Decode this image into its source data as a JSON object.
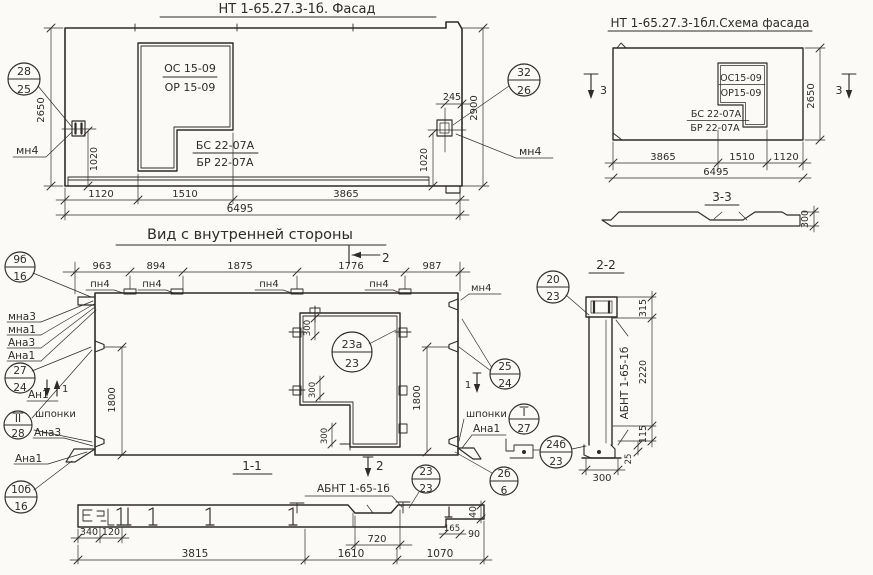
{
  "palette": {
    "paper": "#fbfaf6",
    "ink": "#2e2b28"
  },
  "facade": {
    "title": "НТ 1-65.27.3-1б. Фасад",
    "window_block": {
      "line1": "ОС 15-09",
      "line2": "ОР 15-09"
    },
    "door_block": {
      "line1": "БС 22-07А",
      "line2": "БР 22-07А"
    },
    "plate_left": "мн4",
    "plate_right": "мн4",
    "callout_left": {
      "top": "28",
      "bottom": "25"
    },
    "callout_right": {
      "top": "32",
      "bottom": "26"
    },
    "dim_height_left": "2650",
    "dim_height_right": "2900",
    "dim_plate_left": "1020",
    "dim_plate_right": "1020",
    "dim_offset": "245",
    "dims_bottom": [
      "1120",
      "1510",
      "3865"
    ],
    "dim_total": "6495"
  },
  "scheme": {
    "title": "НТ 1-65.27.3-1бл.Схема фасада",
    "window_block": {
      "line1": "ОС15-09",
      "line2": "ОР15-09"
    },
    "door_block": {
      "line1": "БС 22-07А",
      "line2": "БР 22-07А"
    },
    "section_mark_left": "3",
    "section_mark_right": "3",
    "dim_height": "2650",
    "dims_bottom": [
      "3865",
      "1510",
      "1120"
    ],
    "dim_total": "6495",
    "section33": {
      "title": "3-3",
      "dim_thickness": "300"
    }
  },
  "inner": {
    "title": "Вид с внутренней стороны",
    "section_mark_top": "2",
    "dims_top": [
      "963",
      "894",
      "1875",
      "1776",
      "987"
    ],
    "plate_labels": [
      "пн4",
      "пн4",
      "пн4",
      "пн4"
    ],
    "opening_callout": {
      "top": "23а",
      "bottom": "23"
    },
    "dims_opening": [
      "300",
      "300",
      "300"
    ],
    "dim_left": "1800",
    "dim_right": "1800",
    "left": {
      "callout_top": {
        "top": "9б",
        "bottom": "16"
      },
      "anchor_labels": [
        "мна3",
        "мна1",
        "Ана3",
        "Ана1"
      ],
      "callout_mid": {
        "top": "27",
        "bottom": "24"
      },
      "anchor_an": "Ан1",
      "section_mark": "1",
      "keys_label": "шпонки",
      "callout_keys": {
        "top": "II",
        "bottom": "28"
      },
      "anchor_ana3": "Ана3",
      "anchor_ana1": "Ана1",
      "callout_bottom": {
        "top": "10б",
        "bottom": "16"
      }
    },
    "right": {
      "plate": "мн4",
      "callout_mid": {
        "top": "25",
        "bottom": "24"
      },
      "section_mark": "1",
      "keys_label": "шпонки",
      "callout_keys": {
        "top": "I",
        "bottom": "27"
      },
      "anchor_ana1": "Ана1",
      "callout_corner": {
        "top": "2б",
        "bottom": "6"
      },
      "callout_top": {
        "top": "20",
        "bottom": "23"
      },
      "callout_pad": {
        "top": "24б",
        "bottom": "23"
      }
    }
  },
  "section22": {
    "title": "2-2",
    "label": "АБНТ 1-65-1б",
    "dim_top": "315",
    "dim_middle": "2220",
    "dim_bottom": "115",
    "dim_foot": "25",
    "dim_width": "300"
  },
  "section11": {
    "title": "1-1",
    "section_mark": "2",
    "label": "АБНТ 1-65-1б",
    "callout": {
      "top": "23",
      "bottom": "23"
    },
    "dim_a": "340",
    "dim_b": "120",
    "dims_bottom": [
      "3815",
      "1610",
      "1070"
    ],
    "dim_key": "720",
    "dim_notch": "165",
    "dim_step": "40",
    "dim_edge": "90"
  }
}
